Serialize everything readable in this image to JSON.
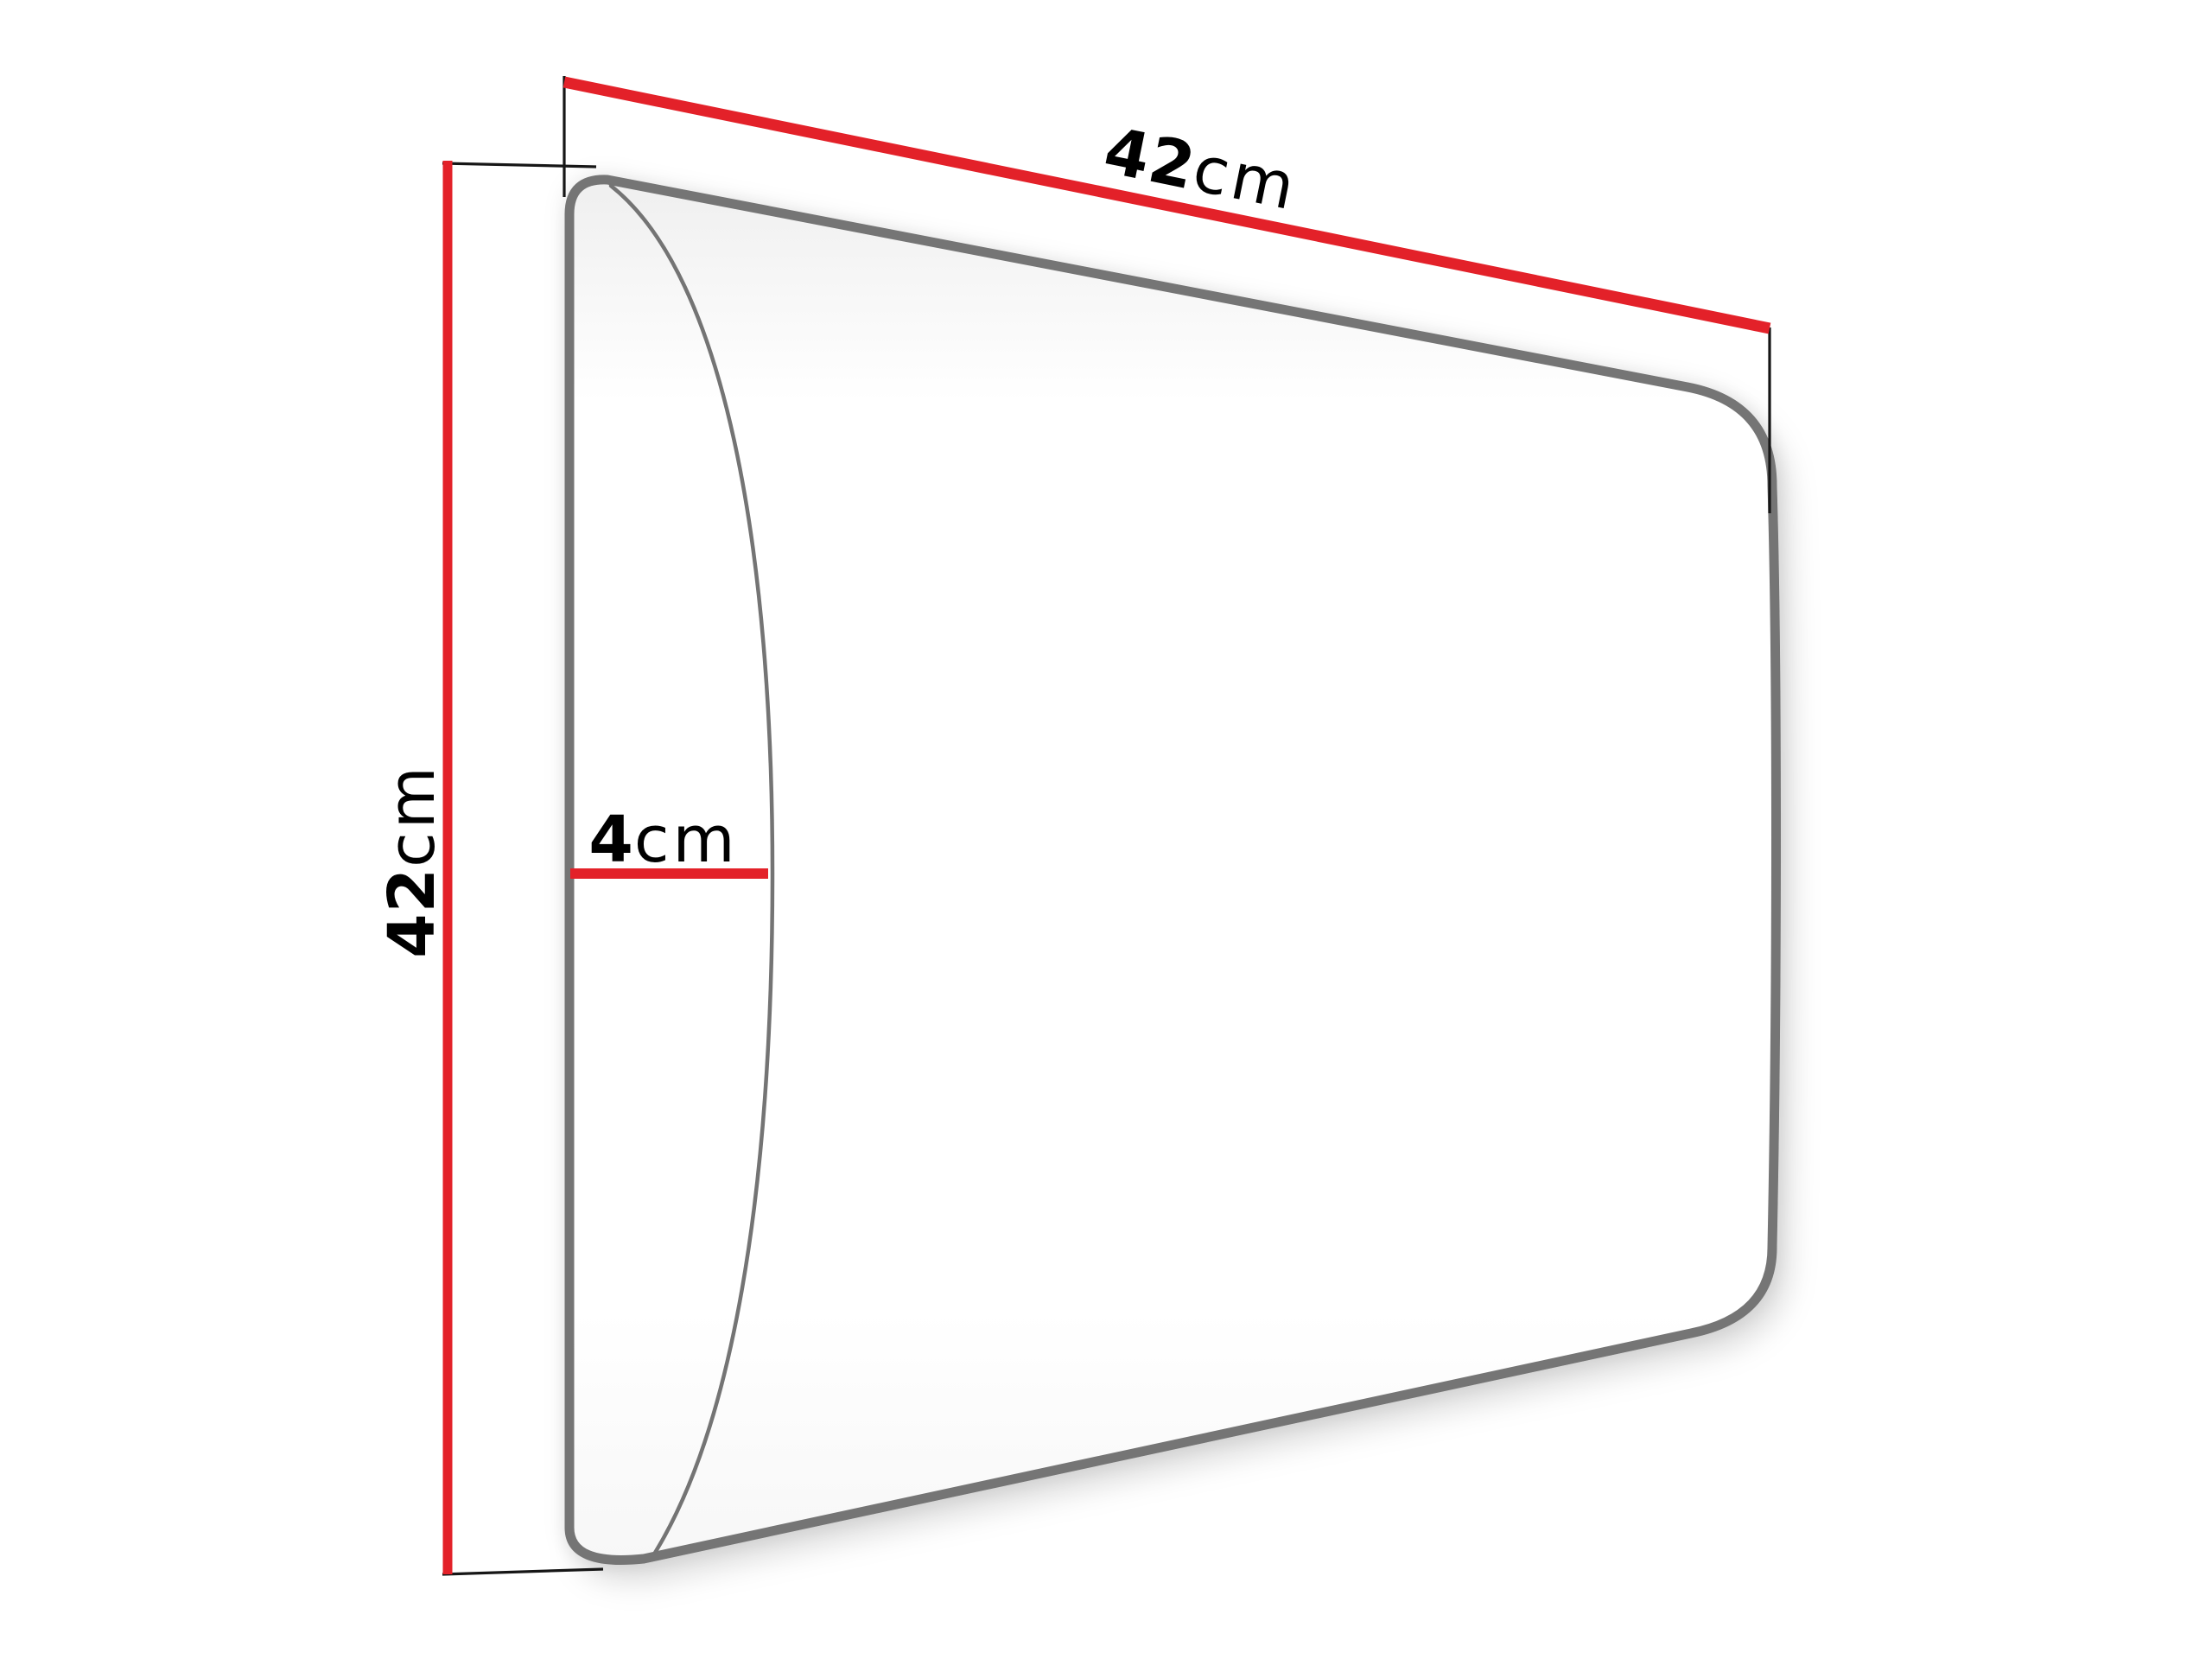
{
  "diagram": {
    "labels": {
      "width": {
        "value": "42",
        "unit": "cm"
      },
      "height": {
        "value": "42",
        "unit": "cm"
      },
      "depth": {
        "value": "4",
        "unit": "cm"
      }
    },
    "colors": {
      "dimension_line": "#e32129",
      "panel_outline": "#747474",
      "extension_line": "#161616",
      "label_text": "#000000",
      "panel_fill": "#ffffff",
      "background": "#ffffff"
    }
  }
}
